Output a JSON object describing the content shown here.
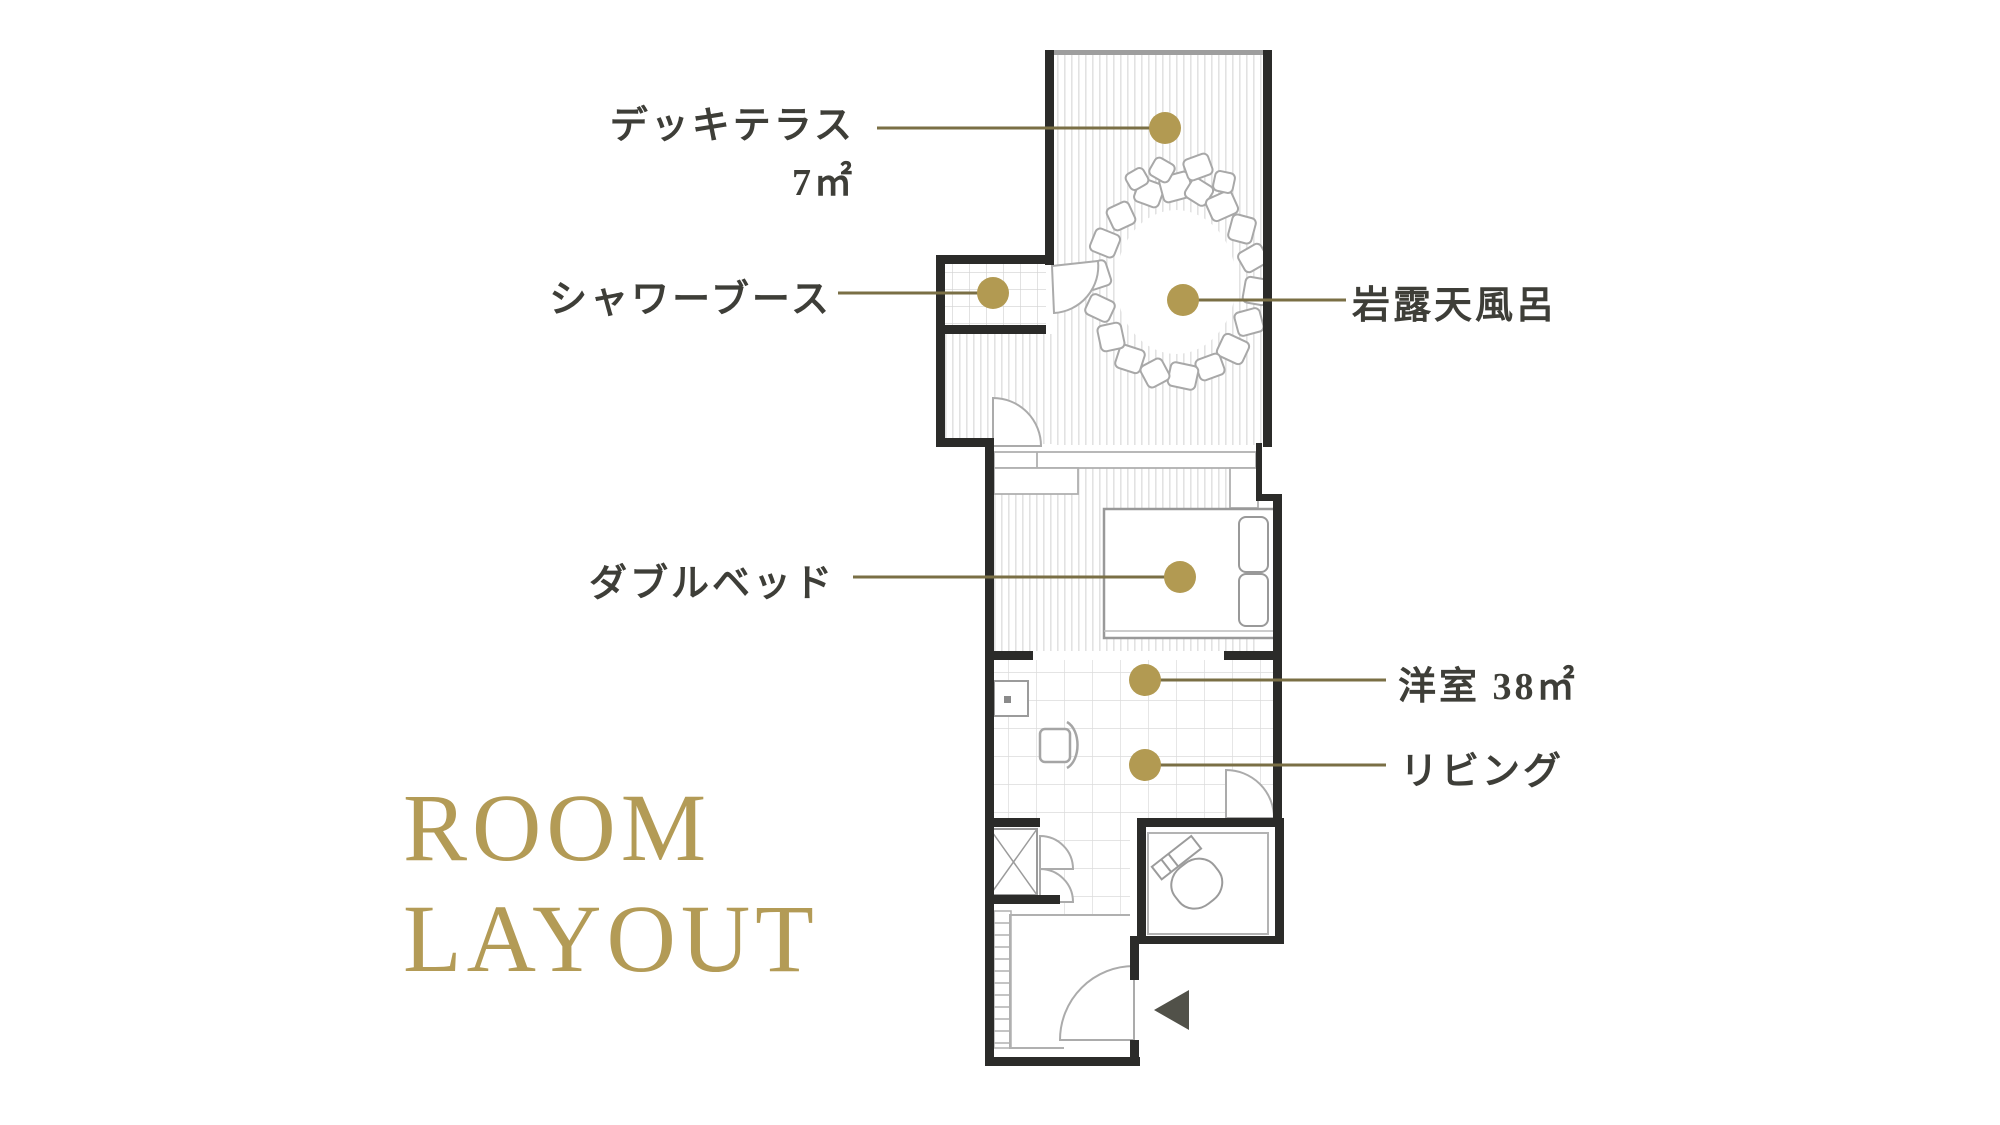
{
  "page": {
    "background_color": "#ffffff"
  },
  "title": {
    "line1": "ROOM",
    "line2": "LAYOUT",
    "color": "#b39b56"
  },
  "floor_plan": {
    "callouts": {
      "deck_terrace": {
        "label": "デッキテラス",
        "area": "7㎡"
      },
      "shower_booth": {
        "label": "シャワーブース"
      },
      "rock_open_air_bath": {
        "label": "岩露天風呂"
      },
      "double_bed": {
        "label": "ダブルベッド"
      },
      "western_room": {
        "label": "洋室 38㎡"
      },
      "living": {
        "label": "リビング"
      }
    },
    "colors": {
      "accent_gold": "#b29a52",
      "leader_line": "#7a6f45",
      "wall": "#2b2b29",
      "fixture_outline": "#a0a0a0",
      "label_text": "#3e3e38"
    }
  }
}
